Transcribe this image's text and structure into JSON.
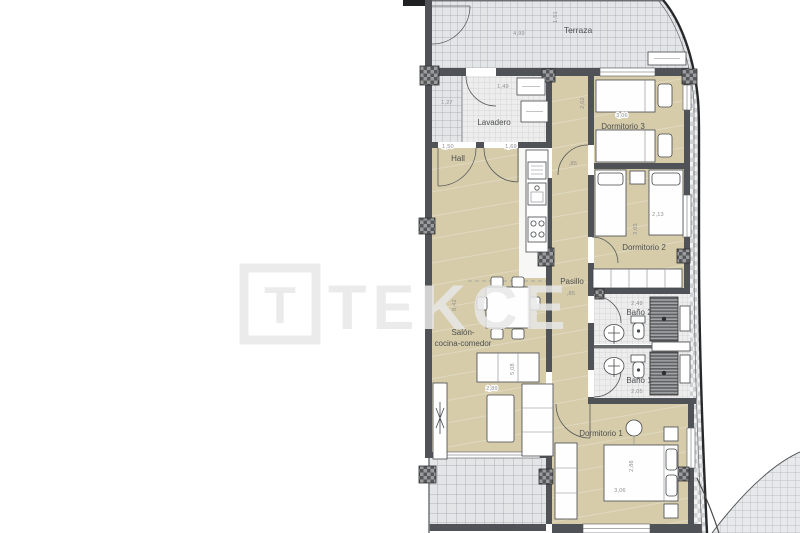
{
  "watermark": {
    "brand": "TEKCE",
    "logo_letter": "T"
  },
  "rooms": {
    "terraza_top": {
      "label": "Terraza",
      "dim_width": "4,99",
      "dim_depth": "1,51",
      "dim_left": "1,27"
    },
    "lavadero": {
      "label": "Lavadero",
      "dim_width": "1,49"
    },
    "hall": {
      "label": "Hall",
      "dim_door_left": "1,50",
      "dim_door_right": "1,69"
    },
    "dormitorio_3": {
      "label": "Dormitorio 3",
      "dim_width": "3,06",
      "dim_depth": "2,02"
    },
    "dormitorio_2": {
      "label": "Dormitorio 2",
      "dim_width": "2,13",
      "dim_depth": "3,03"
    },
    "pasillo": {
      "label": "Pasillo",
      "dim_width_top": ",85",
      "dim_width_bottom": ",85"
    },
    "bano_2": {
      "label": "Baño 2",
      "dim_width": "2,49"
    },
    "bano_1": {
      "label": "Baño 1",
      "dim_width": "2,05"
    },
    "salon": {
      "label_line_1": "Salón-",
      "label_line_2": "cocina-comedor",
      "dim_depth": "8,42",
      "dim_inner_depth": "5,08",
      "dim_width": "2,89"
    },
    "dormitorio_1": {
      "label": "Dormitorio 1",
      "dim_depth": "2,86",
      "dim_width": "3,06"
    },
    "terraza_bottom": {
      "label": "Terraza"
    }
  },
  "colors": {
    "room_floor": "#d6ccaa",
    "terrace_tile": "#e3e5e7",
    "bath_tile": "#ededed",
    "wall": "#4f5256",
    "watermark": "#e8e8e8"
  }
}
